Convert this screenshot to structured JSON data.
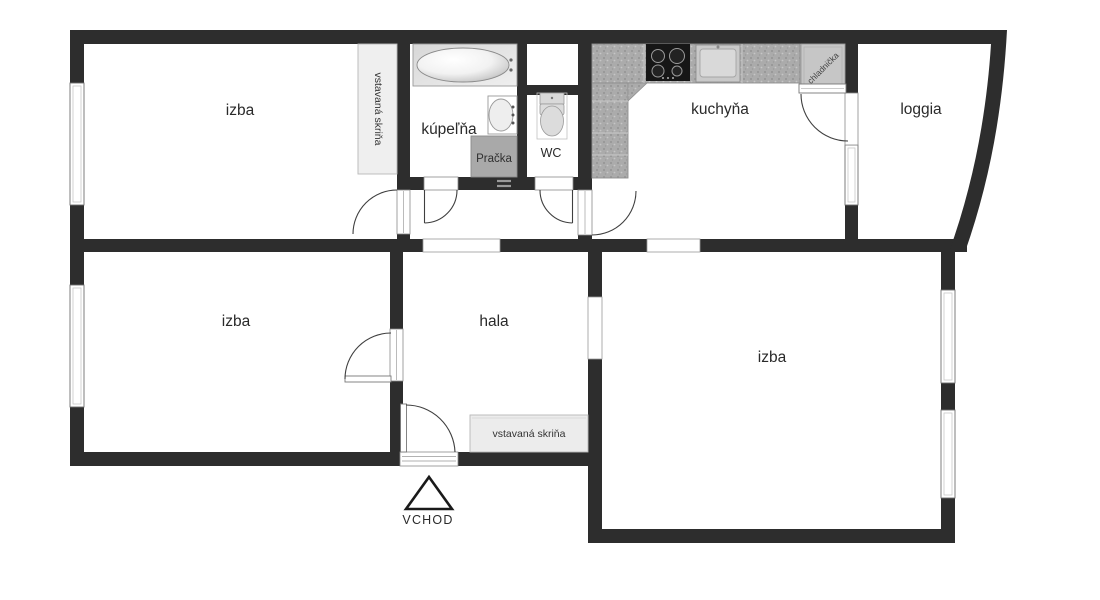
{
  "plan": {
    "rooms": {
      "izba_top_left": "izba",
      "izba_bottom_left": "izba",
      "izba_bottom_right": "izba",
      "hala": "hala",
      "kuchyna": "kuchyňa",
      "kupelna": "kúpeľňa",
      "wc": "WC",
      "loggia": "loggia"
    },
    "fixtures": {
      "wardrobe_top": "vstavaná skriňa",
      "wardrobe_hall": "vstavaná skriňa",
      "washing_machine": "Pračka",
      "fridge": "chladnička"
    },
    "entrance": "VCHOD"
  },
  "colors": {
    "wall": "#2d2d2d",
    "background": "#ffffff",
    "counter_gray": "#ababab",
    "wardrobe_fill": "#efefef",
    "hall_wardrobe_fill": "#ececec",
    "washer_fill": "#a9a9a9",
    "fridge_fill": "#c6c6c6"
  }
}
